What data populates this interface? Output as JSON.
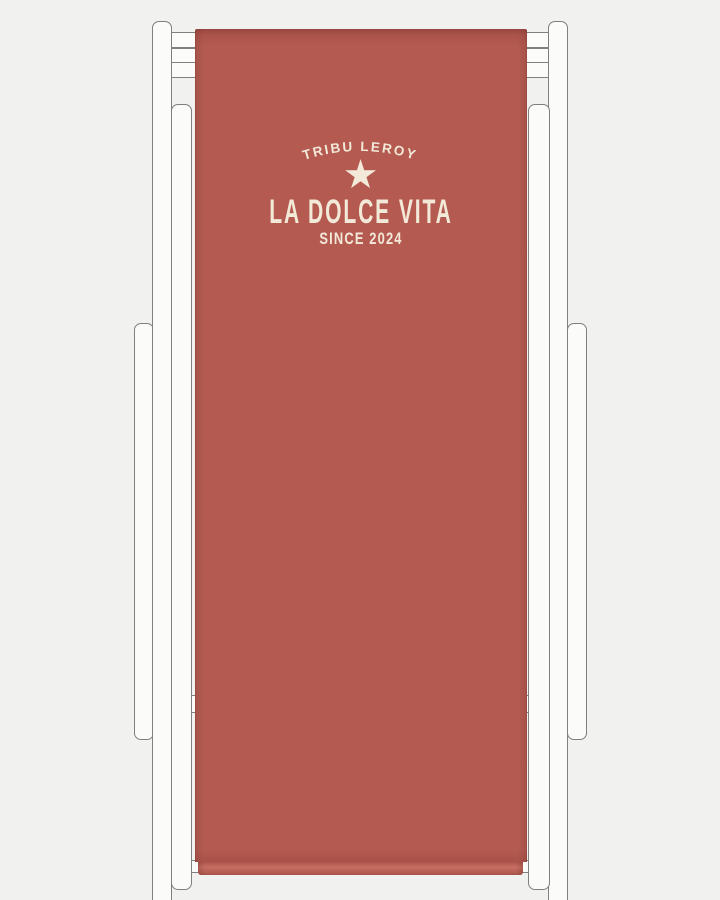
{
  "canvas_print": {
    "brand_arc": "TRIBU LEROY",
    "star_icon": "★",
    "title": "LA DOLCE VITA",
    "subtitle": "SINCE 2024"
  },
  "colors": {
    "background": "#f1f1ef",
    "frame-fill": "#fbfbfa",
    "frame-stroke": "#7f7f7f",
    "fabric": "#b45a51",
    "fabric-hem-light": "#c66e61",
    "text-cream": "#f2e9d8"
  }
}
